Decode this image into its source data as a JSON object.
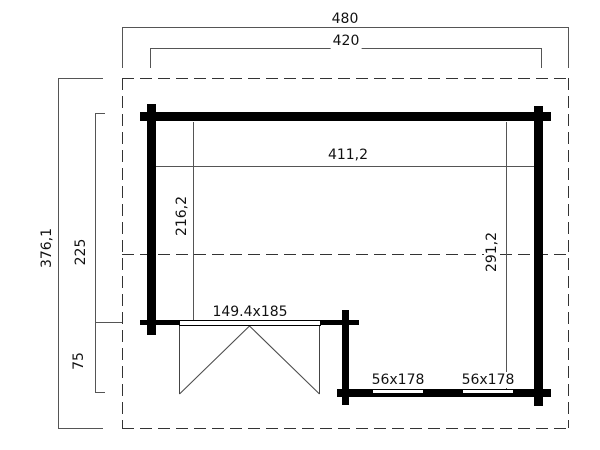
{
  "diagram": {
    "type": "floor-plan",
    "subject": "log cabin with covered porch, top view",
    "units": "cm",
    "colors": {
      "background": "#ffffff",
      "wall": "#000000",
      "dimension_line": "#555555",
      "roof_dashed_line": "#333333",
      "text": "#111111"
    },
    "labels": {
      "roof_overall_width": "480",
      "wall_outer_width": "420",
      "roof_overall_depth": "376,1",
      "left_section_depth": "225",
      "porch_depth": "75",
      "interior_width": "411,2",
      "interior_depth_left": "216,2",
      "interior_depth_right": "291,2",
      "door_size": "149.4x185",
      "window_left_size": "56x178",
      "window_right_size": "56x178"
    }
  }
}
